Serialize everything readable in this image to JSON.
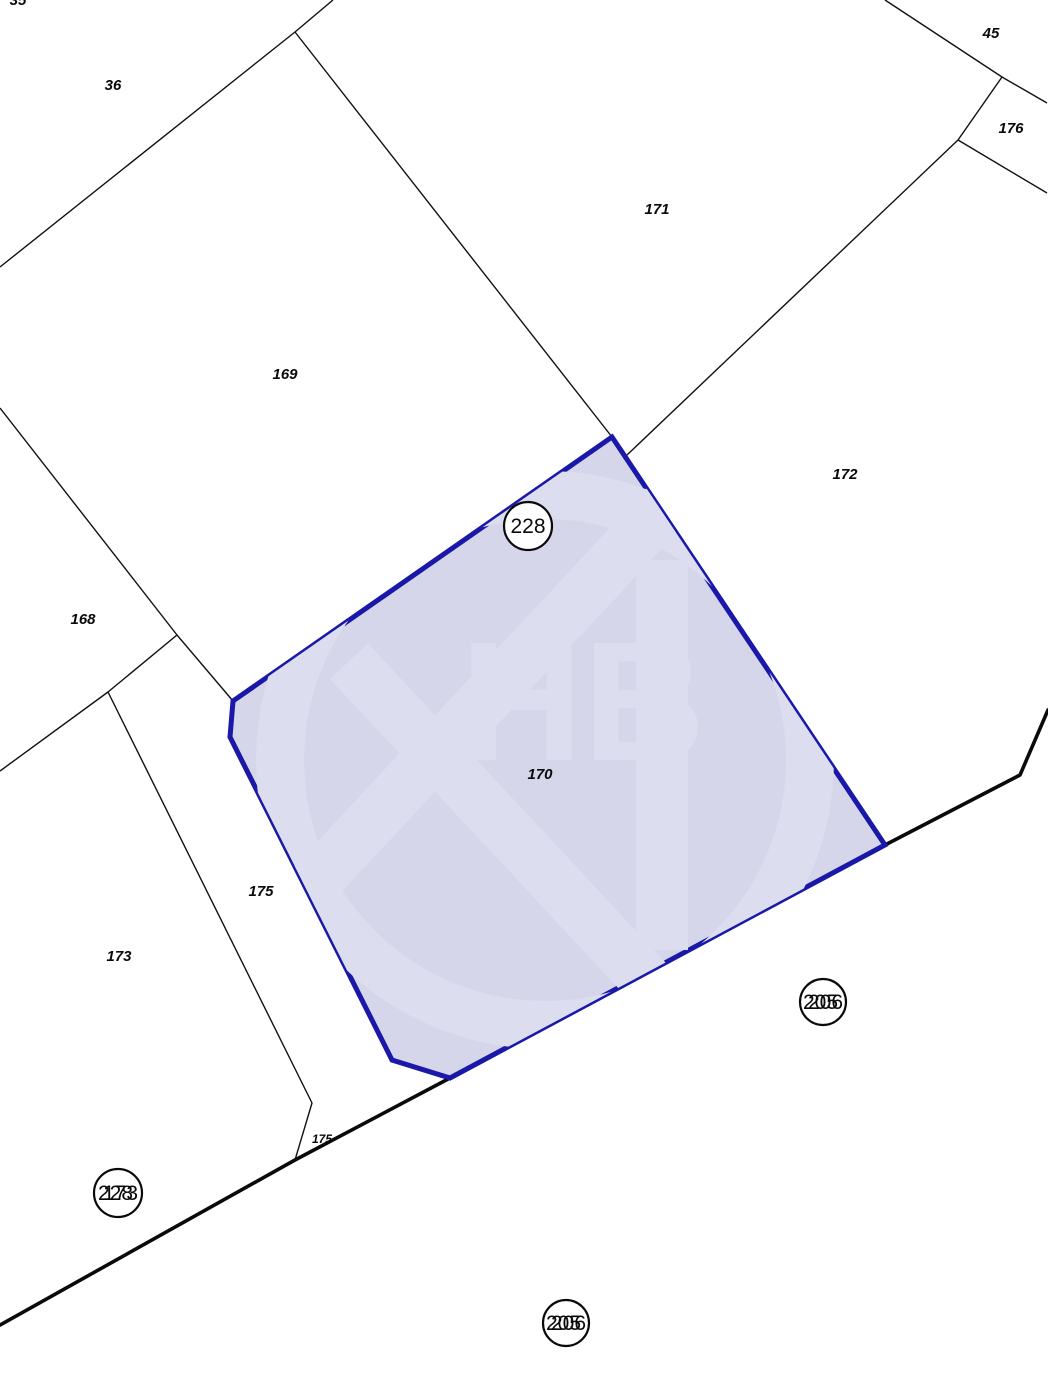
{
  "map": {
    "background": "#ffffff",
    "boundary_color": "#111111",
    "boundary_width": 1.4,
    "road_color": "#0a0a0a",
    "road_width": 3.6,
    "road_points": [
      [
        0,
        1325
      ],
      [
        295,
        1160
      ],
      [
        450,
        1078
      ],
      [
        885,
        845
      ],
      [
        1020,
        775
      ],
      [
        1048,
        710
      ]
    ],
    "boundaries": [
      {
        "name": "boundary-36",
        "points": [
          [
            0,
            267
          ],
          [
            295,
            32
          ],
          [
            333,
            0
          ]
        ]
      },
      {
        "name": "boundary-169-171",
        "points": [
          [
            295,
            32
          ],
          [
            612,
            437
          ]
        ]
      },
      {
        "name": "boundary-45",
        "points": [
          [
            885,
            0
          ],
          [
            1002,
            77
          ],
          [
            1047,
            103
          ]
        ]
      },
      {
        "name": "boundary-45-176",
        "points": [
          [
            1002,
            77
          ],
          [
            958,
            140
          ]
        ]
      },
      {
        "name": "boundary-176-172",
        "points": [
          [
            958,
            140
          ],
          [
            1047,
            193
          ]
        ]
      },
      {
        "name": "boundary-171-172",
        "points": [
          [
            958,
            140
          ],
          [
            627,
            455
          ]
        ]
      },
      {
        "name": "boundary-168-169",
        "points": [
          [
            0,
            408
          ],
          [
            177,
            635
          ],
          [
            233,
            701
          ]
        ]
      },
      {
        "name": "boundary-168-173",
        "points": [
          [
            177,
            635
          ],
          [
            108,
            692
          ],
          [
            0,
            771
          ]
        ]
      },
      {
        "name": "boundary-173-175",
        "points": [
          [
            108,
            692
          ],
          [
            312,
            1103
          ],
          [
            295,
            1160
          ]
        ]
      }
    ],
    "highlight": {
      "parcel_number": "170",
      "fill": "#d5d6ea",
      "stroke": "#1a18a8",
      "stroke_width": 5,
      "points": [
        [
          612,
          437
        ],
        [
          885,
          845
        ],
        [
          450,
          1078
        ],
        [
          392,
          1060
        ],
        [
          230,
          737
        ],
        [
          233,
          701
        ]
      ],
      "label": {
        "text": "170",
        "x": 540,
        "y": 779
      }
    },
    "watermark": {
      "text": "HB",
      "color": "#dcdeef"
    },
    "labels": [
      {
        "text": "35",
        "x": 18,
        "y": 5,
        "small": false
      },
      {
        "text": "36",
        "x": 113,
        "y": 90,
        "small": false
      },
      {
        "text": "45",
        "x": 991,
        "y": 38,
        "small": false
      },
      {
        "text": "176",
        "x": 1011,
        "y": 133,
        "small": false
      },
      {
        "text": "171",
        "x": 657,
        "y": 214,
        "small": false
      },
      {
        "text": "169",
        "x": 285,
        "y": 379,
        "small": false
      },
      {
        "text": "172",
        "x": 845,
        "y": 479,
        "small": false
      },
      {
        "text": "168",
        "x": 83,
        "y": 624,
        "small": false
      },
      {
        "text": "175",
        "x": 261,
        "y": 896,
        "small": false
      },
      {
        "text": "173",
        "x": 119,
        "y": 961,
        "small": false
      },
      {
        "text": "175",
        "x": 322,
        "y": 1143,
        "small": true
      }
    ],
    "circled_labels": [
      {
        "name": "point-label-228",
        "x": 528,
        "y": 526,
        "r": 24,
        "texts": [
          "228"
        ]
      },
      {
        "name": "point-label-205-206",
        "x": 823,
        "y": 1002,
        "r": 23,
        "texts": [
          "205",
          "206"
        ]
      },
      {
        "name": "point-label-228-173",
        "x": 118,
        "y": 1193,
        "r": 24,
        "texts": [
          "228",
          "173"
        ]
      },
      {
        "name": "point-label-205-206",
        "x": 566,
        "y": 1323,
        "r": 23,
        "texts": [
          "205",
          "206"
        ]
      }
    ]
  }
}
